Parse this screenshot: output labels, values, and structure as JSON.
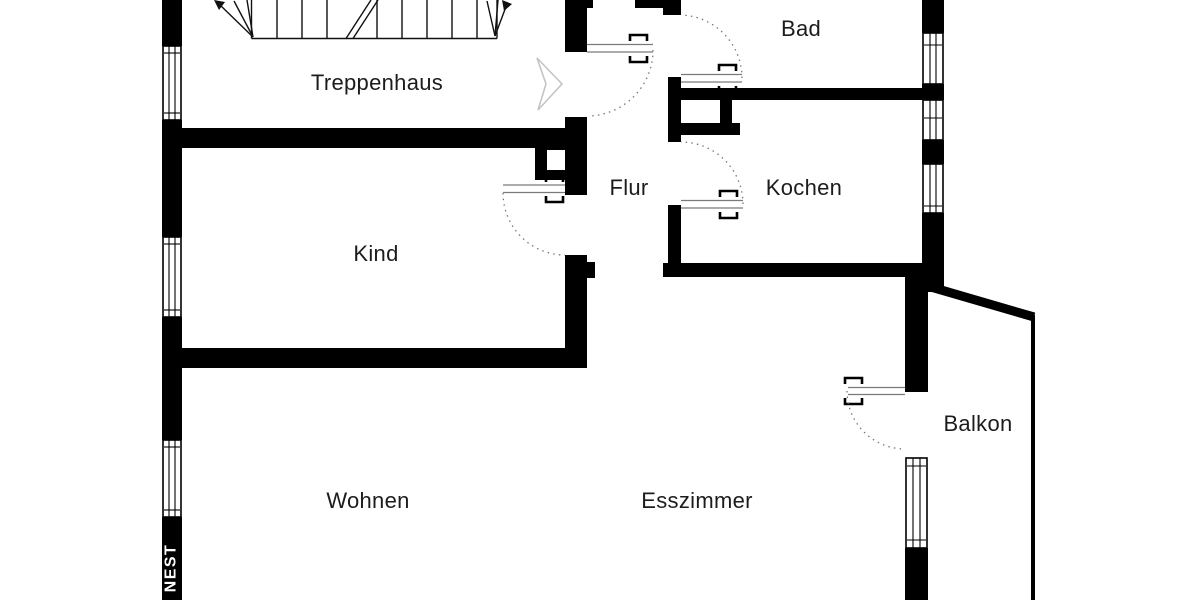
{
  "rooms": {
    "treppenhaus": {
      "label": "Treppenhaus"
    },
    "bad": {
      "label": "Bad"
    },
    "flur": {
      "label": "Flur"
    },
    "kochen": {
      "label": "Kochen"
    },
    "kind": {
      "label": "Kind"
    },
    "wohnen": {
      "label": "Wohnen"
    },
    "esszimmer": {
      "label": "Esszimmer"
    },
    "balkon": {
      "label": "Balkon"
    }
  },
  "watermark": {
    "text": "NEST"
  },
  "colors": {
    "background": "#ffffff",
    "walls": "#000000",
    "room_text": "#1c1c1c",
    "door_swing_arc": "#777777",
    "direction_arrow": "#c4c4c4",
    "watermark_text": "#ffffff"
  },
  "symbols": {
    "door_swing_arc": "dotted-quarter-circle",
    "window": "double-line-in-wall",
    "staircase": "treads-with-up-arrows",
    "direction_arrow": "hollow-right-triangle",
    "chimney_shaft": "black-box-white-core"
  }
}
